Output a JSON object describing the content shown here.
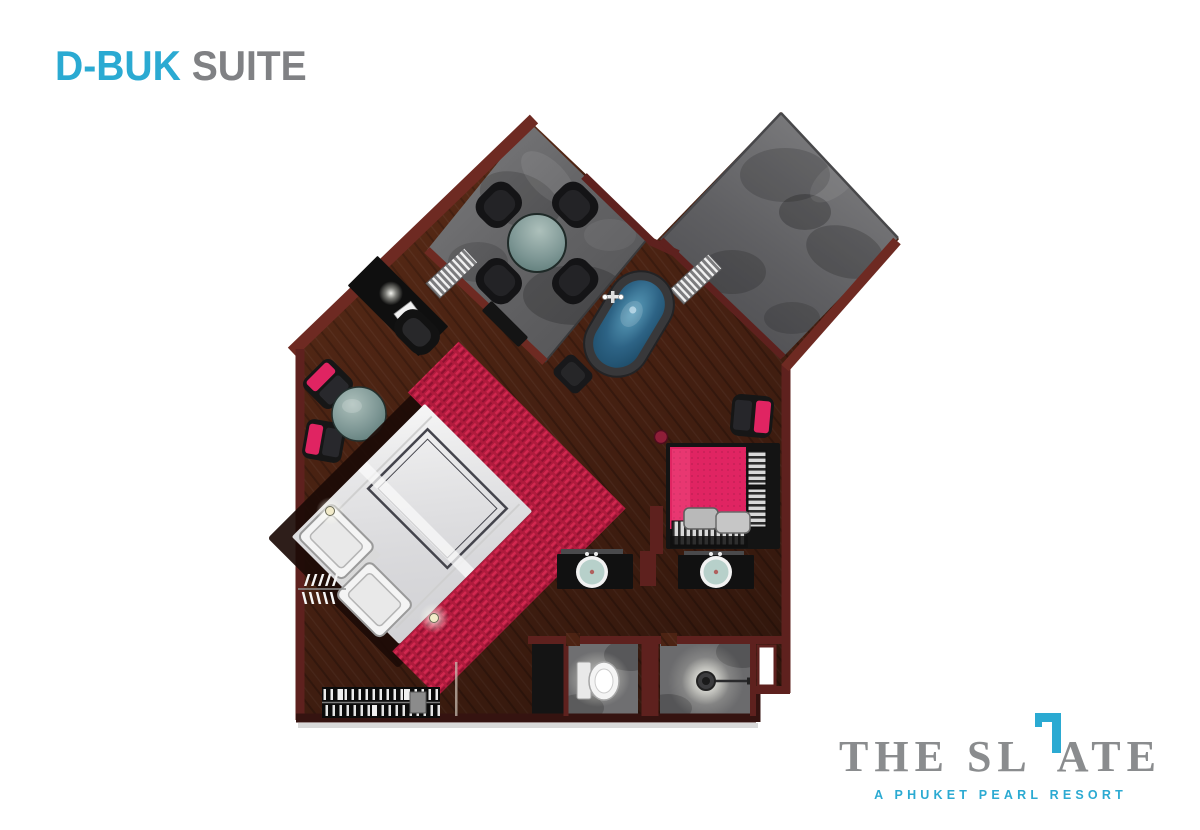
{
  "header": {
    "title_accent": "D-BUK",
    "title_rest": " SUITE"
  },
  "brand": {
    "wordmark_pre": "THE SL",
    "wordmark_post": "ATE",
    "tagline": "A PHUKET PEARL RESORT"
  },
  "colors": {
    "accent": "#2BAAD2",
    "title_gray": "#808184",
    "logo_gray": "#8A8C8E",
    "wall": "#5E211E",
    "wall_bright": "#6E2A22",
    "wall_dark": "#351310",
    "wood": "#4C2313",
    "terrace_gray": "#6A6A6C",
    "water_blue": "#2D6385",
    "hot_pink": "#E02462",
    "bed_red": "#B01B3D",
    "furniture_dark": "#161616",
    "table_teal": "#7E9795"
  },
  "floorplan": {
    "name": "D-BUK Suite floor plan",
    "elements": [
      "terrace-dining",
      "terrace",
      "bathtub",
      "bed",
      "desk",
      "lounge-chairs",
      "side-table",
      "daybed",
      "vanity-left",
      "vanity-right",
      "toilet-room",
      "shower-room",
      "wardrobe"
    ]
  }
}
